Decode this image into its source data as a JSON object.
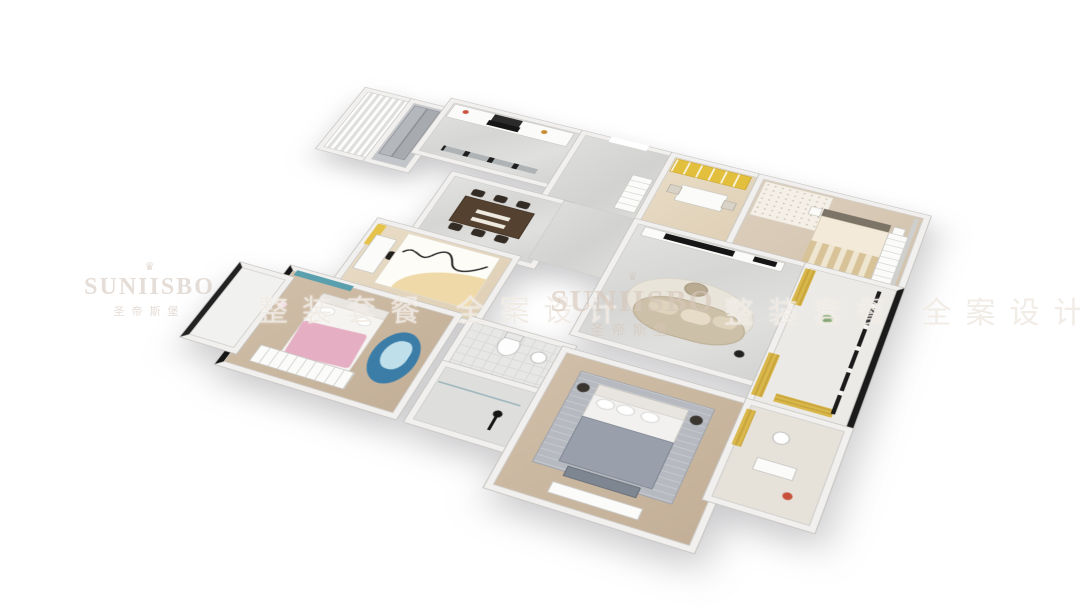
{
  "meta": {
    "scene": "3D isometric cutaway rendering of a full apartment floor plan, viewed from above on a white background",
    "background": "#ffffff"
  },
  "watermarks": {
    "brand_logo": "SUNIISBO",
    "brand_logo_cn": "圣帝斯堡",
    "crown_icon": "♛",
    "slogan": "整装套餐 全案设计"
  },
  "palette": {
    "wall": "#f1f0ee",
    "wall_edge": "#c6c5c2",
    "marble_floor": "#dcdcda",
    "wood_floor_light": "#e6d7bf",
    "wood_floor_dark": "#cbb9a4",
    "accent_gold_curtain": "#d8b74b",
    "accent_yellow_shelf": "#e3bf3e",
    "sofa_beige": "#cdc0a8",
    "dining_table_walnut": "#54412f",
    "master_bed_gray": "#99a0ac",
    "kids_blanket_pink": "#e5aec3",
    "kids_rug_blue": "#3c7da8",
    "curtain_teal": "#5a9fae",
    "fixture_black": "#1b1b1b"
  },
  "rooms": [
    {
      "name": "kitchen",
      "floor": "marble",
      "features": "white cabinets, black cooktop and hood, black framed glass sliding door"
    },
    {
      "name": "laundry-nook",
      "floor": "white",
      "features": "ribbed white curtain"
    },
    {
      "name": "entry-wardrobe",
      "features": "gray sliding-door closet"
    },
    {
      "name": "dining-room",
      "floor": "marble",
      "features": "dark walnut table with six chairs"
    },
    {
      "name": "foyer",
      "floor": "marble",
      "features": "entrance opening, white shoe cabinet"
    },
    {
      "name": "study",
      "floor": "wood",
      "features": "yellow bookshelf wall, desk with two chairs"
    },
    {
      "name": "bedroom-guest",
      "floor": "wood",
      "features": "bed with striped beige duvet, floral rug, white wardrobe"
    },
    {
      "name": "living-room",
      "floor": "marble",
      "features": "marble TV wall with black TV, curved beige sofa, round rug"
    },
    {
      "name": "balcony-right",
      "features": "black framed windows, gold curtains"
    },
    {
      "name": "kids-study-bedroom",
      "floor": "wood",
      "features": "desk with black chair, yellow curtain, beige arc rug with black squiggle"
    },
    {
      "name": "kids-bedroom-pink",
      "floor": "wood",
      "features": "bed with pink blanket, teal window, blue wavy rug, white wardrobe, black floor window"
    },
    {
      "name": "balcony-left",
      "features": "small white balcony"
    },
    {
      "name": "bathroom-wc",
      "floor": "tile",
      "features": "toilet and washbasin"
    },
    {
      "name": "bathroom-shower",
      "floor": "tile",
      "features": "glass shower, black fixtures"
    },
    {
      "name": "master-bedroom",
      "floor": "wood",
      "features": "gray double bed, gray rug, bench, white dresser"
    },
    {
      "name": "master-ensuite",
      "features": "gold curtain, white fixtures"
    }
  ]
}
